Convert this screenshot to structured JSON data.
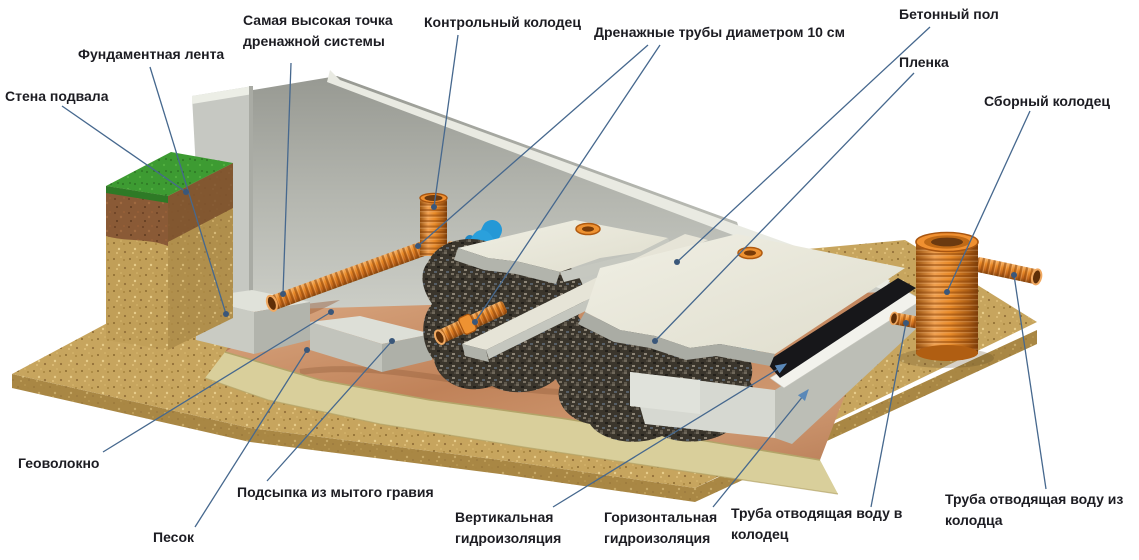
{
  "diagram": {
    "type": "construction-cutaway",
    "subject": "foundation drainage system cross-section",
    "labels": {
      "basement_wall": "Стена подвала",
      "foundation_strip": "Фундаментная лента",
      "highest_point": "Самая высокая точка\nдренажной системы",
      "control_well": "Контрольный колодец",
      "drainage_pipes": "Дренажные трубы диаметром 10 см",
      "concrete_floor": "Бетонный пол",
      "film": "Пленка",
      "collection_well": "Сборный колодец",
      "geotextile": "Геоволокно",
      "gravel_bed": "Подсыпка из мытого гравия",
      "sand": "Песок",
      "vertical_waterproofing": "Вертикальная\nгидроизоляция",
      "horizontal_waterproofing": "Горизонтальная\nгидроизоляция",
      "pipe_to_well": "Труба отводящая воду в\nколодец",
      "pipe_from_well": "Труба отводящая воду из\nколодца"
    },
    "palette": {
      "label_text": "#1c1c22",
      "leader_line": "#46688e",
      "leader_dot": "#3a577a",
      "pipe_orange": "#e07a1c",
      "water_film_blue": "#2196d0",
      "concrete_light": "#e9e7da",
      "wall_gray": "#c6c8c2",
      "ground_sand": "#c7a55e",
      "grass_green": "#3d9b32",
      "topsoil_brown": "#8a5a36",
      "gravel_dark": "#3a352c",
      "membrane_copper": "#c88a66",
      "waterproofing_black": "#17171a",
      "underlay_yellow": "#d9cf9b"
    }
  }
}
